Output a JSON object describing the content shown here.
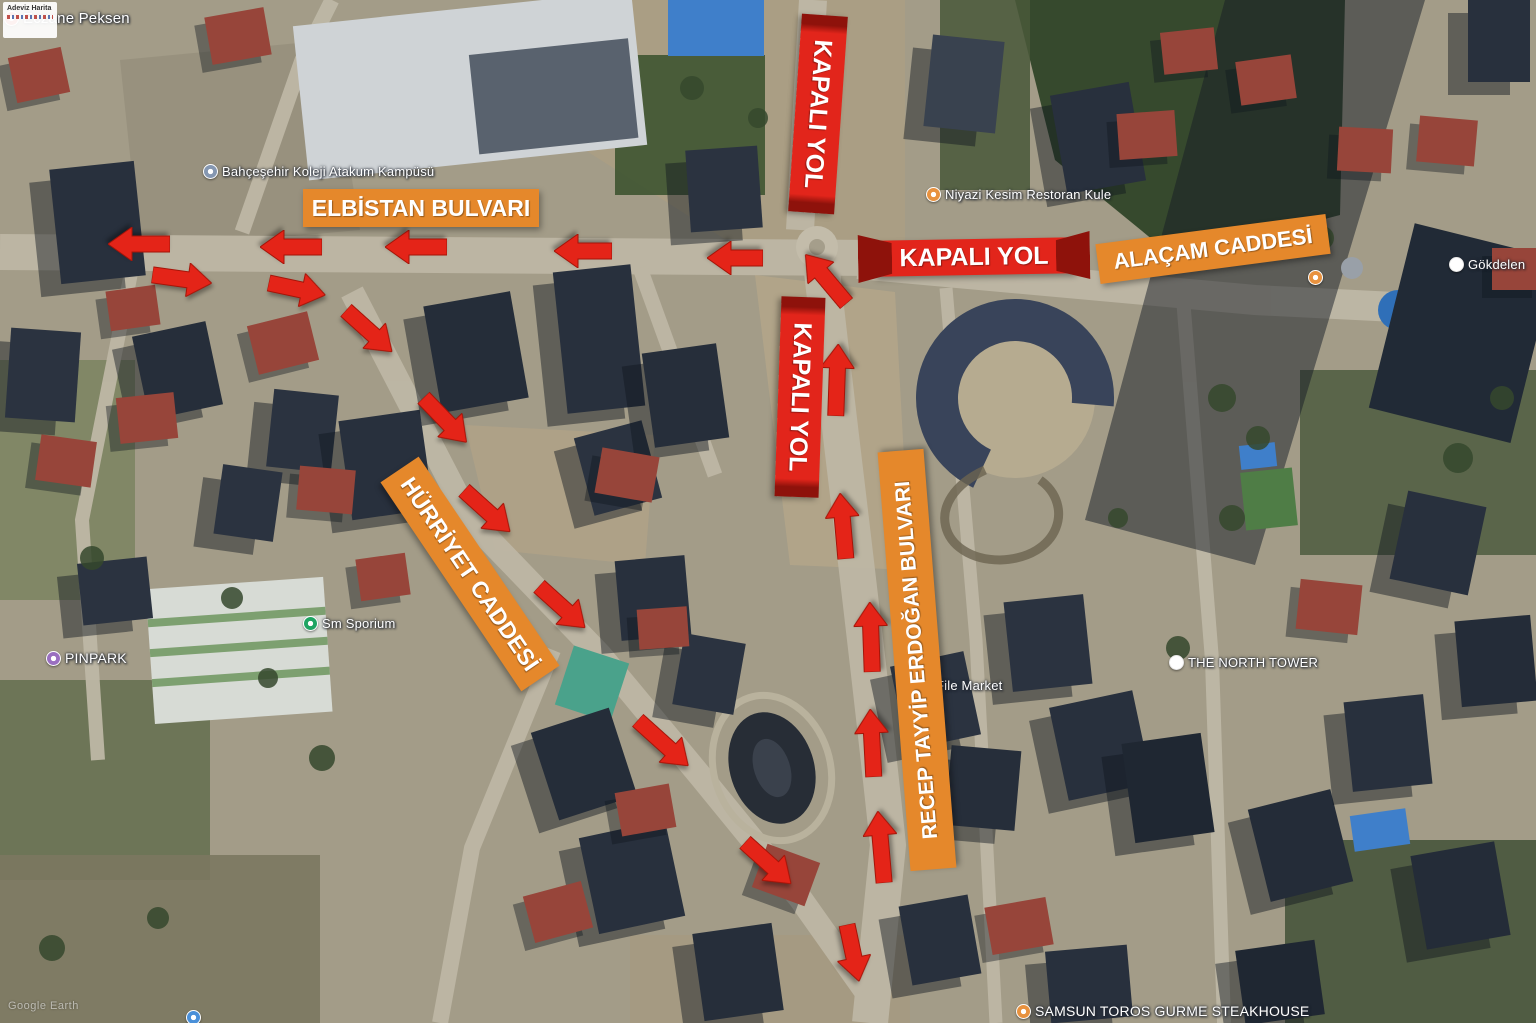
{
  "colors": {
    "banner_orange": "#e5882b",
    "banner_red": "#e2251b",
    "banner_red_dark": "#8e120b",
    "arrow_red": "#e42418"
  },
  "watermarks": {
    "provider": "Adeviz Harita",
    "attribution": "Google Earth"
  },
  "map_labels": [
    {
      "id": "eczane-peksen",
      "text": "Eczane Peksen",
      "x": 4,
      "y": 10,
      "size": 15,
      "icon": "pharmacy-icon",
      "icon_color": "#d94f43"
    },
    {
      "id": "bahcesehir-koleji",
      "text": "Bahçeşehir Koleji Atakum Kampüsü",
      "x": 203,
      "y": 164,
      "size": 13,
      "icon": "school-icon",
      "icon_color": "#8597b1"
    },
    {
      "id": "niyazi-kesim",
      "text": "Niyazi Kesim Restoran Kule",
      "x": 926,
      "y": 187,
      "size": 13,
      "icon": "restaurant-icon",
      "icon_color": "#e8923f"
    },
    {
      "id": "gokdelen",
      "text": "Gökdelen",
      "x": 1449,
      "y": 257,
      "size": 13,
      "icon": "poi-icon",
      "icon_color": "#ffffff"
    },
    {
      "id": "orange-poi",
      "text": "",
      "x": 1308,
      "y": 270,
      "size": 13,
      "icon": "hotel-icon",
      "icon_color": "#e8923f"
    },
    {
      "id": "pinpark",
      "text": "PINPARK",
      "x": 46,
      "y": 650,
      "size": 14,
      "icon": "attraction-icon",
      "icon_color": "#9a6fc0"
    },
    {
      "id": "sm-sporium",
      "text": "Sm Sporium",
      "x": 303,
      "y": 616,
      "size": 13,
      "icon": "store-icon",
      "icon_color": "#1fa463"
    },
    {
      "id": "file-market",
      "text": "File Market",
      "x": 936,
      "y": 678,
      "size": 13,
      "icon": null,
      "icon_color": null
    },
    {
      "id": "the-north-tower",
      "text": "THE NORTH TOWER",
      "x": 1169,
      "y": 655,
      "size": 13,
      "icon": "poi-icon",
      "icon_color": "#ffffff"
    },
    {
      "id": "samsun-toros-steakhouse",
      "text": "SAMSUN TOROS GURME STEAKHOUSE",
      "x": 1016,
      "y": 1003,
      "size": 14,
      "icon": "restaurant-icon",
      "icon_color": "#e8923f"
    },
    {
      "id": "blue-poi",
      "text": "",
      "x": 186,
      "y": 1010,
      "size": 13,
      "icon": "poi-blue-icon",
      "icon_color": "#4a90d9"
    }
  ],
  "street_banners": [
    {
      "id": "elbistan",
      "text": "ELBİSTAN BULVARI",
      "x": 421,
      "y": 208,
      "w": 236,
      "h": 38,
      "rot": 0,
      "fs": 23
    },
    {
      "id": "alacam",
      "text": "ALAÇAM CADDESİ",
      "x": 1213,
      "y": 249,
      "w": 232,
      "h": 40,
      "rot": -7.5,
      "fs": 22
    },
    {
      "id": "hurriyet",
      "text": "HÜRRİYET CADDESİ",
      "x": 470,
      "y": 574,
      "w": 252,
      "h": 46,
      "rot": 56,
      "fs": 23
    },
    {
      "id": "recep-tayyip-erdogan",
      "text": "RECEP TAYYİP ERDOĞAN BULVARI",
      "x": 917,
      "y": 660,
      "w": 420,
      "h": 46,
      "rot": -94.5,
      "fs": 21
    }
  ],
  "closure_banners": [
    {
      "id": "kapali-yol-top",
      "text": "KAPALI YOL",
      "x": 818,
      "y": 114,
      "w": 198,
      "h": 46,
      "rot": 94,
      "fs": 25,
      "style": "capped"
    },
    {
      "id": "kapali-yol-mid",
      "text": "KAPALI YOL",
      "x": 800,
      "y": 397,
      "w": 200,
      "h": 44,
      "rot": 92,
      "fs": 25,
      "style": "capped"
    },
    {
      "id": "kapali-yol-horizontal",
      "text": "KAPALI YOL",
      "x": 974,
      "y": 257,
      "w": 200,
      "h": 36,
      "rot": -1,
      "fs": 25,
      "style": "ribbon"
    }
  ],
  "arrows": [
    {
      "x": 139,
      "y": 244,
      "angle": 180,
      "len": 62
    },
    {
      "x": 291,
      "y": 247,
      "angle": 180,
      "len": 62
    },
    {
      "x": 416,
      "y": 247,
      "angle": 180,
      "len": 62
    },
    {
      "x": 583,
      "y": 251,
      "angle": 180,
      "len": 58
    },
    {
      "x": 735,
      "y": 258,
      "angle": 180,
      "len": 56
    },
    {
      "x": 182,
      "y": 279,
      "angle": 8,
      "len": 60
    },
    {
      "x": 297,
      "y": 289,
      "angle": 12,
      "len": 58
    },
    {
      "x": 369,
      "y": 331,
      "angle": 42,
      "len": 62
    },
    {
      "x": 445,
      "y": 420,
      "angle": 46,
      "len": 62
    },
    {
      "x": 487,
      "y": 511,
      "angle": 42,
      "len": 62
    },
    {
      "x": 562,
      "y": 607,
      "angle": 42,
      "len": 62
    },
    {
      "x": 663,
      "y": 743,
      "angle": 42,
      "len": 68
    },
    {
      "x": 768,
      "y": 863,
      "angle": 42,
      "len": 62
    },
    {
      "x": 853,
      "y": 953,
      "angle": 78,
      "len": 58
    },
    {
      "x": 881,
      "y": 847,
      "angle": -95,
      "len": 72
    },
    {
      "x": 872,
      "y": 743,
      "angle": -93,
      "len": 68
    },
    {
      "x": 871,
      "y": 637,
      "angle": -92,
      "len": 70
    },
    {
      "x": 843,
      "y": 526,
      "angle": -95,
      "len": 66
    },
    {
      "x": 837,
      "y": 380,
      "angle": -88,
      "len": 72
    },
    {
      "x": 826,
      "y": 279,
      "angle": -130,
      "len": 64
    }
  ]
}
